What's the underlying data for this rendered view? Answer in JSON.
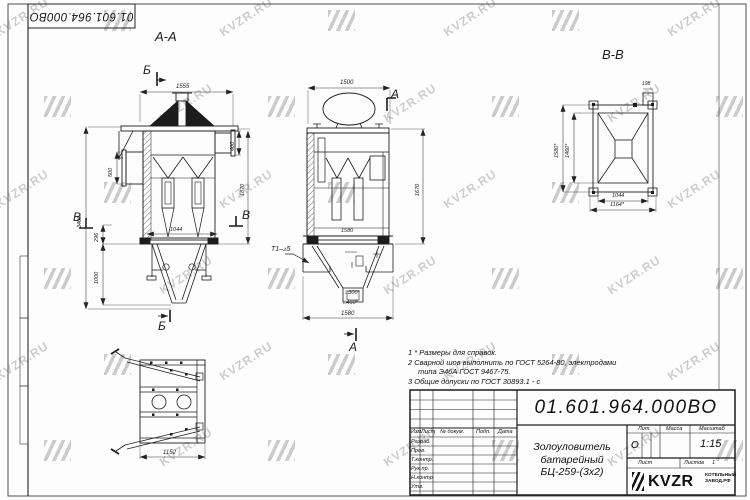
{
  "watermark": {
    "text": "KVZR.RU"
  },
  "corner_stamp": {
    "doc_number": "01.601.964.000ВО"
  },
  "views": {
    "section_aa": {
      "title": "А-А",
      "marker_top": "Б",
      "marker_bottom": "Б",
      "marker_left": "В",
      "marker_right": "В",
      "dims": {
        "width_top": "1555",
        "duct_height": "400",
        "flange_height": "500",
        "body_height": "1870",
        "total_height": "3400",
        "hopper_height": "1000",
        "band_height": "296",
        "width_bottom": "1044"
      }
    },
    "front": {
      "marker_top": "А",
      "marker_bottom": "А",
      "weld_note": "Т1–▵5",
      "dims": {
        "width_top": "1500",
        "height_right": "1670",
        "width_inner": "1580",
        "width_bottom": "1580",
        "outlet_inner": "□300*",
        "outlet_outer": "□460*"
      }
    },
    "section_vv": {
      "title": "В-В",
      "dims": {
        "stub": "198",
        "height_outer": "1580*",
        "height_inner": "1460*",
        "width_inner": "1044",
        "width_outer": "1164*"
      }
    },
    "top_view": {
      "dims": {
        "width": "1152"
      }
    }
  },
  "notes": {
    "line1": "1 * Размеры для справок.",
    "line2": "2 Сварной шов выполнить по ГОСТ 5264-80, электродами",
    "line3": "типа Э46А ГОСТ 9467-75.",
    "line4": "3 Общие допуски по ГОСТ 30893.1 - с"
  },
  "title_block": {
    "doc_number": "01.601.964.000ВО",
    "product_name_1": "Золоуловитель",
    "product_name_2": "батарейный",
    "product_name_3": "БЦ-259-(3х2)",
    "headers": {
      "izm": "Изм.",
      "list": "Лист",
      "doc": "№ докум.",
      "podp": "Подп.",
      "data": "Дата"
    },
    "rows": [
      "Разраб.",
      "Пров.",
      "Т.контр.",
      "Рук.пр.",
      "Н.контр.",
      "Утв."
    ],
    "lit_label": "Лит.",
    "mass_label": "Масса",
    "scale_label": "Масштаб",
    "lit_value": "О",
    "scale_value": "1:15",
    "sheet_label": "Лист",
    "sheets_label": "Листов",
    "sheets_value": "1",
    "logo_text": "KVZR",
    "company_line1": "КОТЕЛЬНЫЙ",
    "company_line2": "ЗАВОД.РФ"
  }
}
